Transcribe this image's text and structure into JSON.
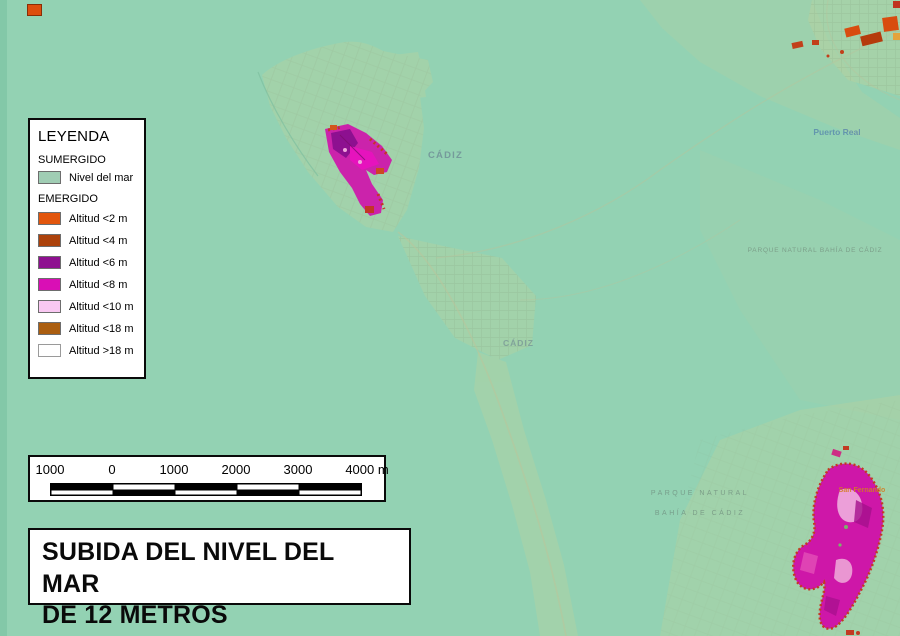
{
  "map": {
    "background_color": "#93d2b3",
    "labels": {
      "cadiz_north": "CÁDIZ",
      "cadiz_south": "CÁDIZ",
      "puerto_real": "Puerto Real",
      "parque_natural_bahia_line": "PARQUE NATURAL BAHÍA DE CÁDIZ",
      "parque_natural": "PARQUE NATURAL",
      "bahia_de_cadiz": "BAHÍA DE CÁDIZ",
      "san_fernando": "San Fernando"
    }
  },
  "legend": {
    "title": "LEYENDA",
    "sumergido_header": "SUMERGIDO",
    "sumergido_items": [
      {
        "label": "Nivel del mar",
        "color": "#a0cdb4"
      }
    ],
    "emergido_header": "EMERGIDO",
    "emergido_items": [
      {
        "label": "Altitud <2 m",
        "color": "#e2560d"
      },
      {
        "label": "Altitud <4 m",
        "color": "#ac420c"
      },
      {
        "label": "Altitud <6 m",
        "color": "#8e1190"
      },
      {
        "label": "Altitud <8 m",
        "color": "#d90fb5"
      },
      {
        "label": "Altitud <10 m",
        "color": "#f9c8f2"
      },
      {
        "label": "Altitud <18 m",
        "color": "#ab5e10"
      },
      {
        "label": "Altitud >18 m",
        "color": "#ffffff"
      }
    ]
  },
  "scalebar": {
    "labels": [
      "1000",
      "0",
      "1000",
      "2000",
      "3000",
      "4000 m"
    ]
  },
  "title": {
    "line1": "SUBIDA DEL NIVEL DEL MAR",
    "line2": "DE 12 METROS"
  }
}
